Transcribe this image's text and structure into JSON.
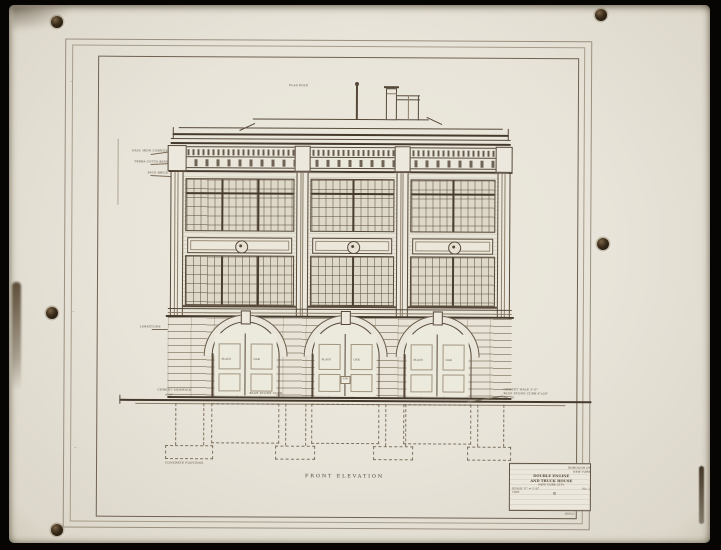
{
  "drawing": {
    "title": "FRONT ELEVATION",
    "roof_note": "FLAG POLE",
    "cornice_notes": {
      "n1": "GALV. IRON CORNICE",
      "n2": "TERRA COTTA BAND",
      "n3": "FACE BRICK"
    },
    "wall_note": "LIMESTONE",
    "grade_notes": {
      "left1": "CEMENT SIDEWALK",
      "left2": "6'-0\"",
      "mid": "BLUE STONE CURB",
      "right1": "CEMENT WALK 5'-0\"",
      "right2": "BLUE STONE CURB 6\"x20\"",
      "right3": "No. 10"
    },
    "footing_note": "CONCRETE FOOTINGS",
    "door_label_left": "PLAIN",
    "door_label_right": "OAK",
    "house_number": "158",
    "edge_marks": [
      "~",
      "~",
      "~"
    ],
    "title_block": {
      "top_right_1": "BOROUGH OF",
      "top_right_2": "NEW YORK",
      "line1": "DOUBLE ENGINE",
      "line2": "AND TRUCK HOUSE",
      "line3": "NEW YORK CITY",
      "scale": "SCALE ¼\" = 1'-0\"",
      "sheet": "No. 2",
      "mark": "B",
      "date": "1905"
    },
    "corner_number": "45621"
  }
}
